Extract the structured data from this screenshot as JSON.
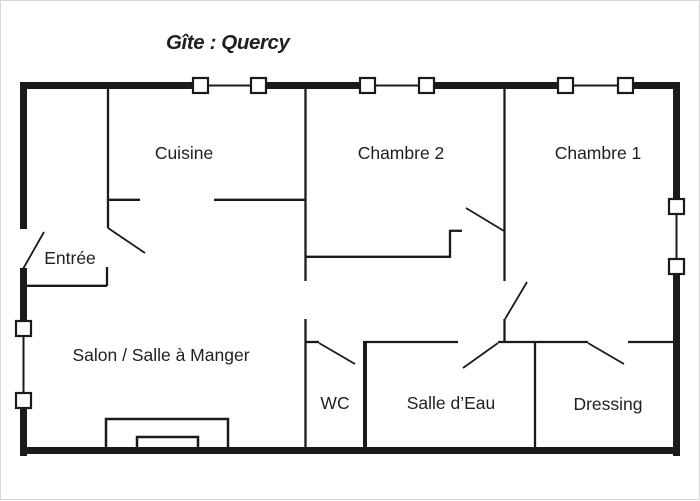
{
  "title": "Gîte : Quercy",
  "rooms": {
    "cuisine": "Cuisine",
    "chambre2": "Chambre 2",
    "chambre1": "Chambre 1",
    "entree": "Entrée",
    "salon": "Salon / Salle à Manger",
    "wc": "WC",
    "salle_deau": "Salle d’Eau",
    "dressing": "Dressing"
  },
  "features": {
    "window_count_top_wall": 6,
    "window_count_left_wall": 2,
    "window_count_right_wall": 2,
    "door_count": 7
  },
  "colors": {
    "wall": "#1a1a1a",
    "text": "#1f1f1f",
    "window_fill": "#ffffff",
    "background": "#ffffff"
  }
}
